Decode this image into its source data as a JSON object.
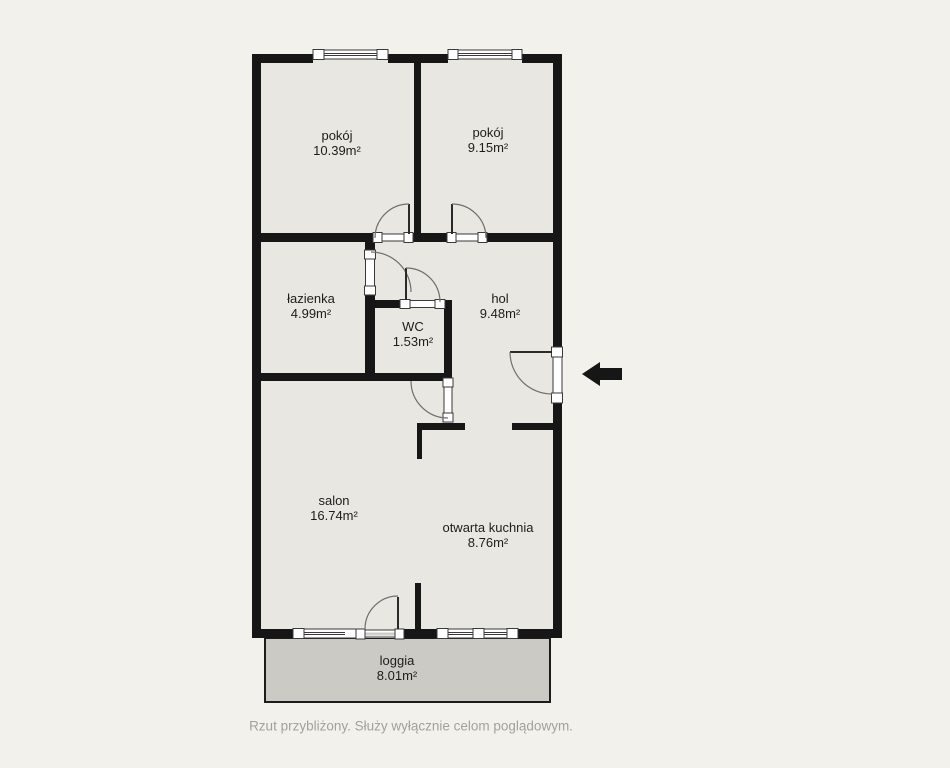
{
  "colors": {
    "background": "#f3f1ec",
    "floor": "#e9e7e1",
    "loggia": "#cbcac5",
    "wall": "#161616",
    "label": "#1d1d1b",
    "caption": "#a2a19d"
  },
  "rooms": [
    {
      "id": "pokoj-1",
      "name": "pokój",
      "area": "10.39m²"
    },
    {
      "id": "pokoj-2",
      "name": "pokój",
      "area": "9.15m²"
    },
    {
      "id": "lazienka",
      "name": "łazienka",
      "area": "4.99m²"
    },
    {
      "id": "wc",
      "name": "WC",
      "area": "1.53m²"
    },
    {
      "id": "hol",
      "name": "hol",
      "area": "9.48m²"
    },
    {
      "id": "salon",
      "name": "salon",
      "area": "16.74m²"
    },
    {
      "id": "otwarta-kuchnia",
      "name": "otwarta kuchnia",
      "area": "8.76m²"
    },
    {
      "id": "loggia",
      "name": "loggia",
      "area": "8.01m²"
    }
  ],
  "entrance": {
    "icon": "arrow-left"
  },
  "caption": "Rzut przybliżony. Służy wyłącznie celom poglądowym."
}
